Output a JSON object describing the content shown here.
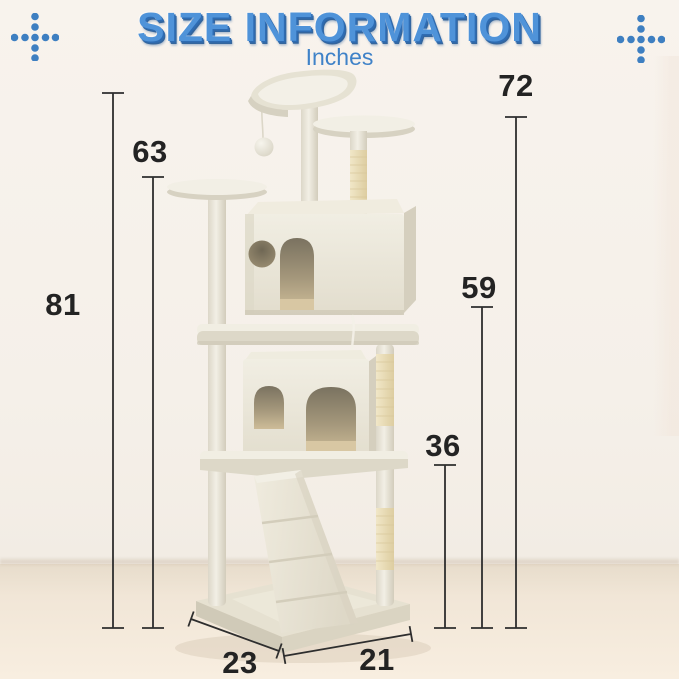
{
  "title": "SIZE INFORMATION",
  "subtitle": "Inches",
  "measurements": {
    "left_outer": "81",
    "left_inner": "63",
    "right_outer": "72",
    "right_middle": "59",
    "right_inner": "36",
    "base_left_edge": "23",
    "base_right_edge": "21"
  },
  "icons": {
    "left_decoration": "dots-cross-icon",
    "right_decoration": "dots-cross-icon",
    "illustration": "cat-tree-illustration"
  },
  "theme": {
    "accent_blue": "#4f93d9",
    "accent_blue_dark": "#3f82c8",
    "dimension_text": "#232323",
    "dimension_line": "#2e2e2e",
    "wall": "#f6f1ea",
    "floor": "#f4e9db",
    "plush": "#efece1",
    "sisal": "#ead9ae"
  }
}
